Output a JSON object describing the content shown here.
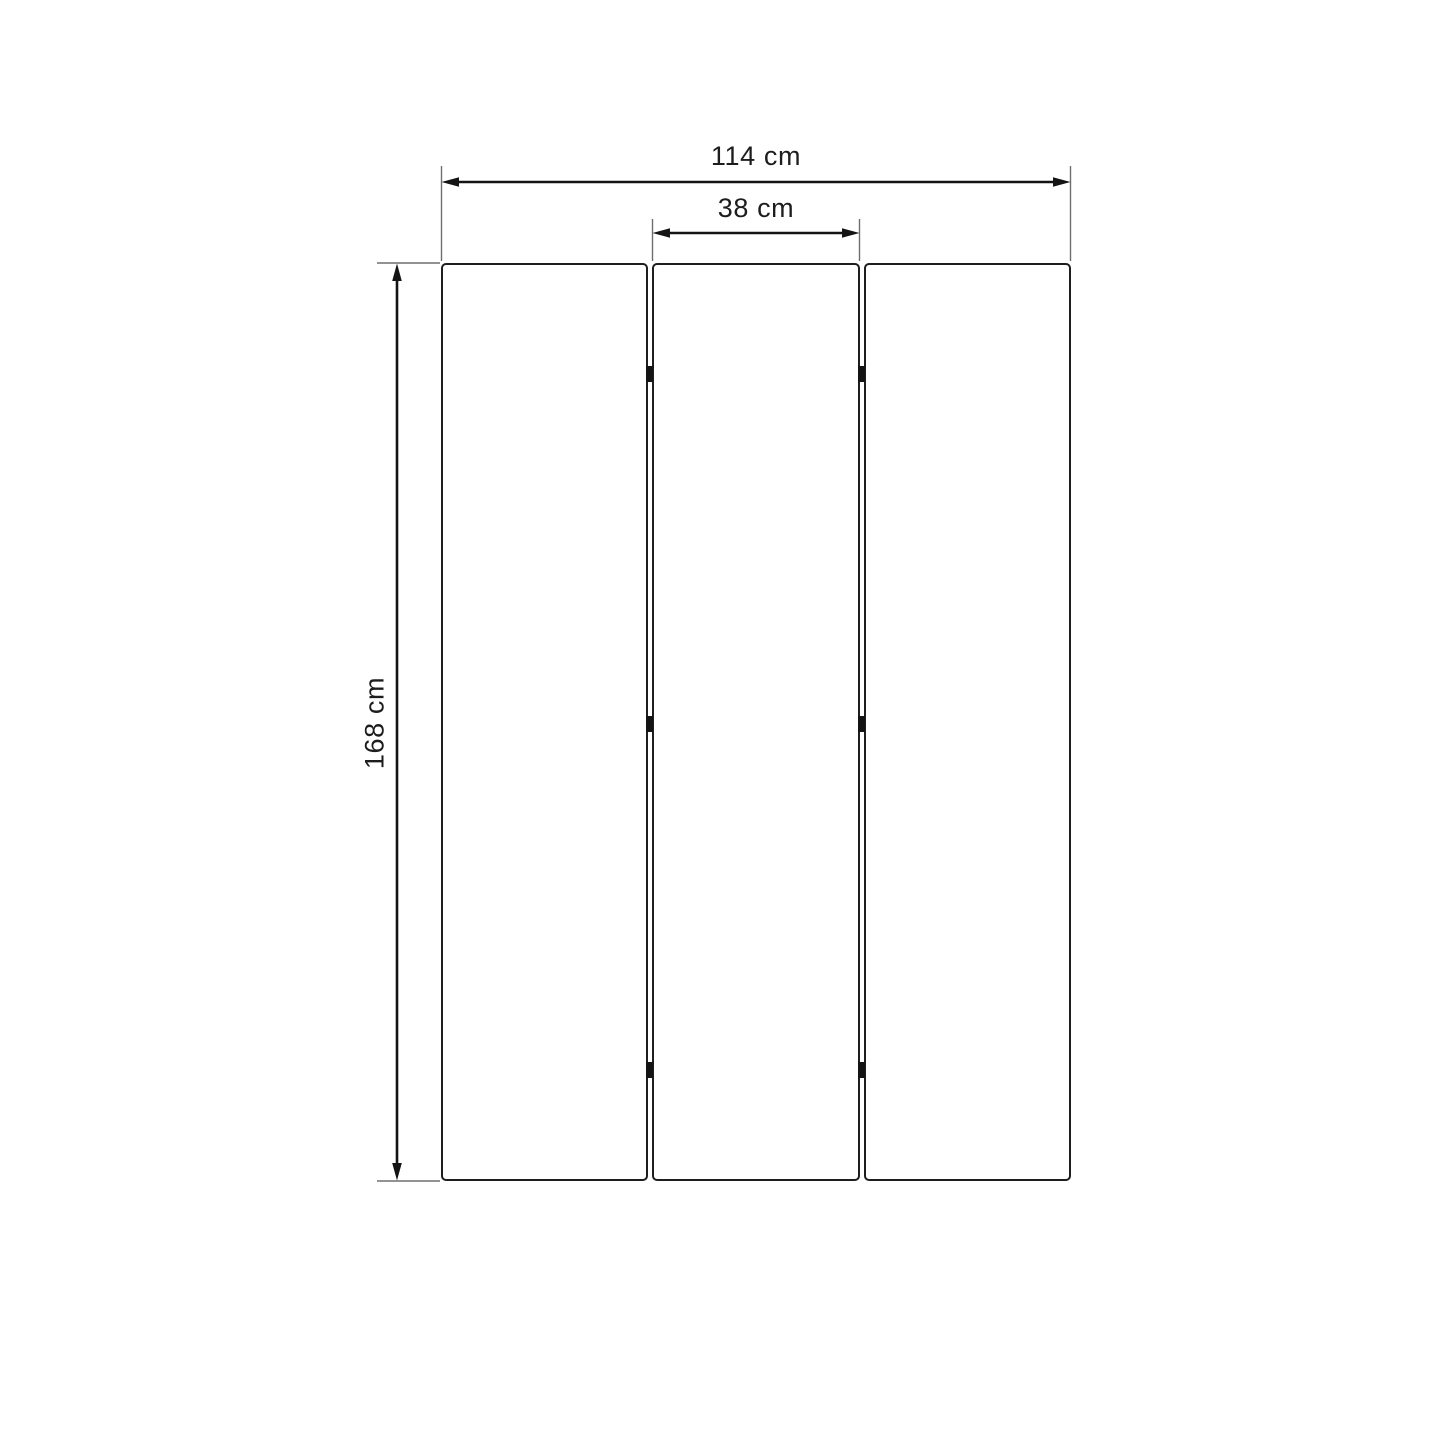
{
  "diagram": {
    "labels": {
      "total_width": "114 cm",
      "panel_width": "38 cm",
      "height": "168 cm"
    },
    "values": {
      "total_width_cm": 114,
      "panel_width_cm": 38,
      "height_cm": 168,
      "unit": "cm"
    },
    "structure": {
      "panel_count": 3,
      "hinge_count": 6,
      "hinges_per_gap": 3
    },
    "colors": {
      "background": "#ffffff",
      "panel_fill": "#ffffff",
      "panel_border": "#1e1e1e",
      "dimension_line": "#141414",
      "extension_line": "#6e6e6e",
      "hinge": "#141414",
      "label_text": "#1d1d1d"
    }
  }
}
